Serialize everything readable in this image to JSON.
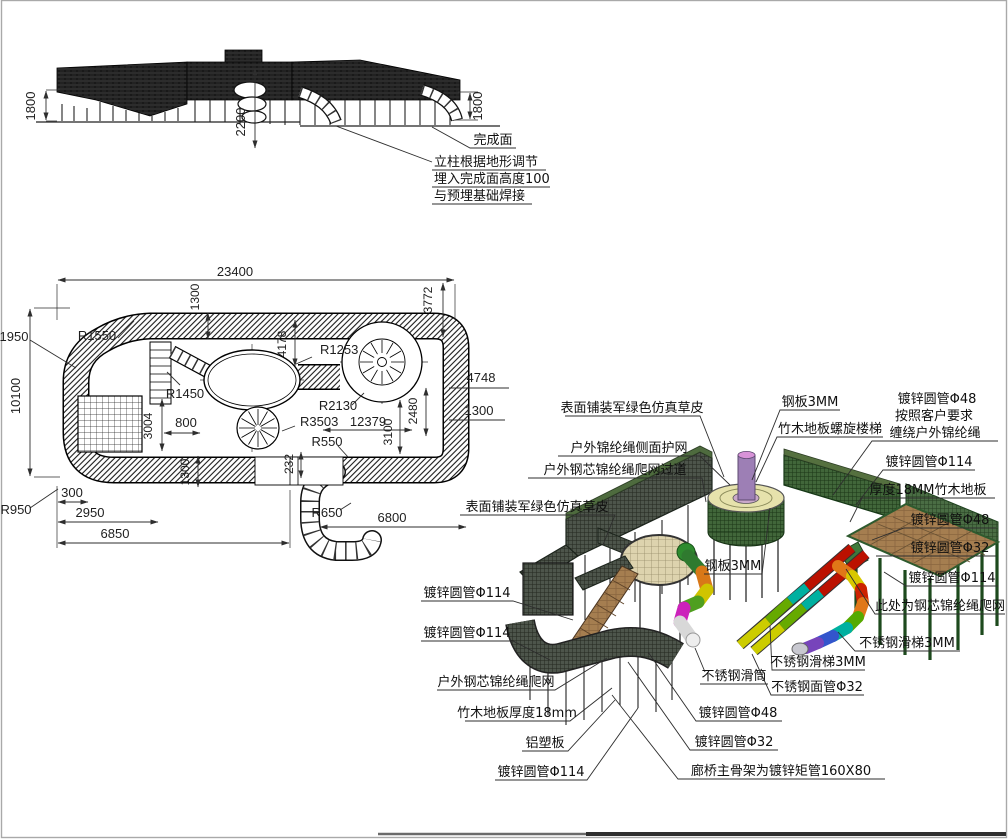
{
  "elev": {
    "dim_left": "1800",
    "dim_mid": "2200",
    "dim_right": "1800",
    "finish_surface": "完成面",
    "note_line1": "立柱根据地形调节",
    "note_line2": "埋入完成面高度100",
    "note_line3": "与预埋基础焊接"
  },
  "plan": {
    "overall_width": "23400",
    "overall_height": "10100",
    "top_band": "1300",
    "right_3772": "3772",
    "left_1950": "1950",
    "r1550": "R1550",
    "r1450": "R1450",
    "d4178": "4178",
    "r1253": "R1253",
    "d3004": "3004",
    "d800": "800",
    "r2130": "R2130",
    "r3503": "R3503",
    "d12379": "12379",
    "d3100": "3100",
    "d2480": "2480",
    "d4748": "4748",
    "right_1300": "1300",
    "r550": "R550",
    "d232": "232",
    "r650": "R650",
    "d6800": "6800",
    "bottom_left_1300": "1300",
    "d300": "300",
    "d2950": "2950",
    "d6850": "6850",
    "r950": "R950"
  },
  "iso": {
    "surface_grass_top": "表面铺装军绿色仿真草皮",
    "side_net": "户外锦纶绳侧面护网",
    "climb_net_walkway": "户外钢芯锦纶绳爬网过道",
    "surface_grass_left": "表面铺装军绿色仿真草皮",
    "steel_plate_top": "钢板3MM",
    "spiral_stairs": "竹木地板螺旋楼梯",
    "pipe48_req1": "镀锌圆管Φ48",
    "pipe48_req2": "按照客户要求",
    "pipe48_req3": "缠绕户外锦纶绳",
    "pipe114_right1": "镀锌圆管Φ114",
    "floor18_right": "厚度18MM竹木地板",
    "pipe48_right": "镀锌圆管Φ48",
    "pipe32_right": "镀锌圆管Φ32",
    "pipe114_right2": "镀锌圆管Φ114",
    "climb_net_here": "此处为钢芯锦纶绳爬网",
    "slide3mm_right": "不锈钢滑梯3MM",
    "steel_plate_mid": "钢板3MM",
    "pipe114_left1": "镀锌圆管Φ114",
    "pipe114_left2": "镀锌圆管Φ114",
    "climb_net_left": "户外钢芯锦纶绳爬网",
    "floor18_left": "竹木地板厚度18mm",
    "alu_panel": "铝塑板",
    "pipe114_bottom": "镀锌圆管Φ114",
    "slide_tube": "不锈钢滑筒",
    "slide3mm_mid": "不锈钢滑梯3MM",
    "face_pipe32": "不锈钢面管Φ32",
    "pipe48_bottom": "镀锌圆管Φ48",
    "pipe32_bottom": "镀锌圆管Φ32",
    "bridge_frame": "廊桥主骨架为镀锌矩管160X80"
  }
}
